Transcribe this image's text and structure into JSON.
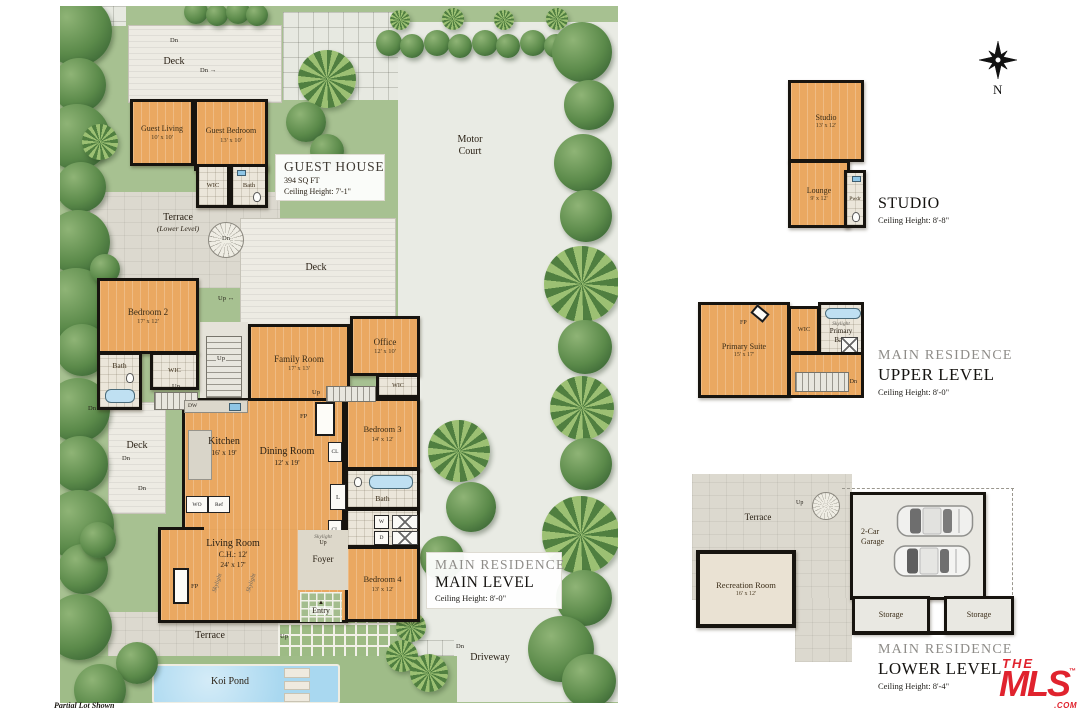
{
  "labels": {
    "up": "Up",
    "dn": "Dn",
    "dw": "DW",
    "wo": "WO",
    "ref": "Ref",
    "fp": "FP",
    "cl": "CL",
    "l": "L",
    "w": "W",
    "d": "D",
    "wic": "WIC",
    "bath": "Bath",
    "deck": "Deck",
    "terrace": "Terrace",
    "skylight": "Skylight",
    "entry": "Entry",
    "foyer": "Foyer",
    "pwdr": "Pwdr",
    "entry_arrow": "▲",
    "arrow_up": "↑",
    "arrow_right": "→",
    "arrow_lr": "↔"
  },
  "site": {
    "motor_court_line1": "Motor",
    "motor_court_line2": "Court",
    "driveway": "Driveway",
    "koi_pond": "Koi Pond",
    "terrace_lower_note": "(Lower Level)",
    "partial_lot_note": "Partial Lot Shown",
    "compass_north": "N"
  },
  "guest_house": {
    "title": "GUEST HOUSE",
    "sqft": "394 SQ FT",
    "ceiling": "Ceiling Height: 7'-1\"",
    "guest_living": {
      "name": "Guest Living",
      "dims": "10' x 10'"
    },
    "guest_bedroom": {
      "name": "Guest Bedroom",
      "dims": "13' x 10'"
    }
  },
  "main_level": {
    "residence": "MAIN RESIDENCE",
    "level": "MAIN LEVEL",
    "ceiling": "Ceiling Height: 8'-0\"",
    "bedroom2": {
      "name": "Bedroom 2",
      "dims": "17' x 12'"
    },
    "family_room": {
      "name": "Family Room",
      "dims": "17' x 13'"
    },
    "office": {
      "name": "Office",
      "dims": "12' x 10'"
    },
    "kitchen": {
      "name": "Kitchen",
      "dims": "16' x 19'"
    },
    "dining_room": {
      "name": "Dining Room",
      "dims": "12' x 19'"
    },
    "living_room": {
      "name": "Living Room",
      "ch": "C.H.: 12'",
      "dims": "24' x 17'"
    },
    "bedroom3": {
      "name": "Bedroom 3",
      "dims": "14' x 12'"
    },
    "bedroom4": {
      "name": "Bedroom 4",
      "dims": "13' x 12'"
    }
  },
  "upper_level": {
    "residence": "MAIN RESIDENCE",
    "level": "UPPER LEVEL",
    "ceiling": "Ceiling Height: 8'-0\"",
    "primary_suite": {
      "name": "Primary Suite",
      "dims": "15' x 17'"
    },
    "primary_bath_line1": "Primary",
    "primary_bath_line2": "Bath"
  },
  "studio": {
    "title": "STUDIO",
    "ceiling": "Ceiling Height: 8'-8\"",
    "studio_room": {
      "name": "Studio",
      "dims": "13' x 12'"
    },
    "lounge": {
      "name": "Lounge",
      "dims": "9' x 12'"
    }
  },
  "lower_level": {
    "residence": "MAIN RESIDENCE",
    "level": "LOWER LEVEL",
    "ceiling": "Ceiling Height: 8'-4\"",
    "recreation_room": {
      "name": "Recreation Room",
      "dims": "16' x 12'"
    },
    "garage_line1": "2-Car",
    "garage_line2": "Garage",
    "storage": "Storage"
  },
  "logo": {
    "the": "THE",
    "mls": "MLS",
    "tm": "™",
    "com": ".COM"
  },
  "colors": {
    "accent_red": "#e0232e",
    "wood_floor": "#eaa861",
    "grass": "#a7c191"
  }
}
